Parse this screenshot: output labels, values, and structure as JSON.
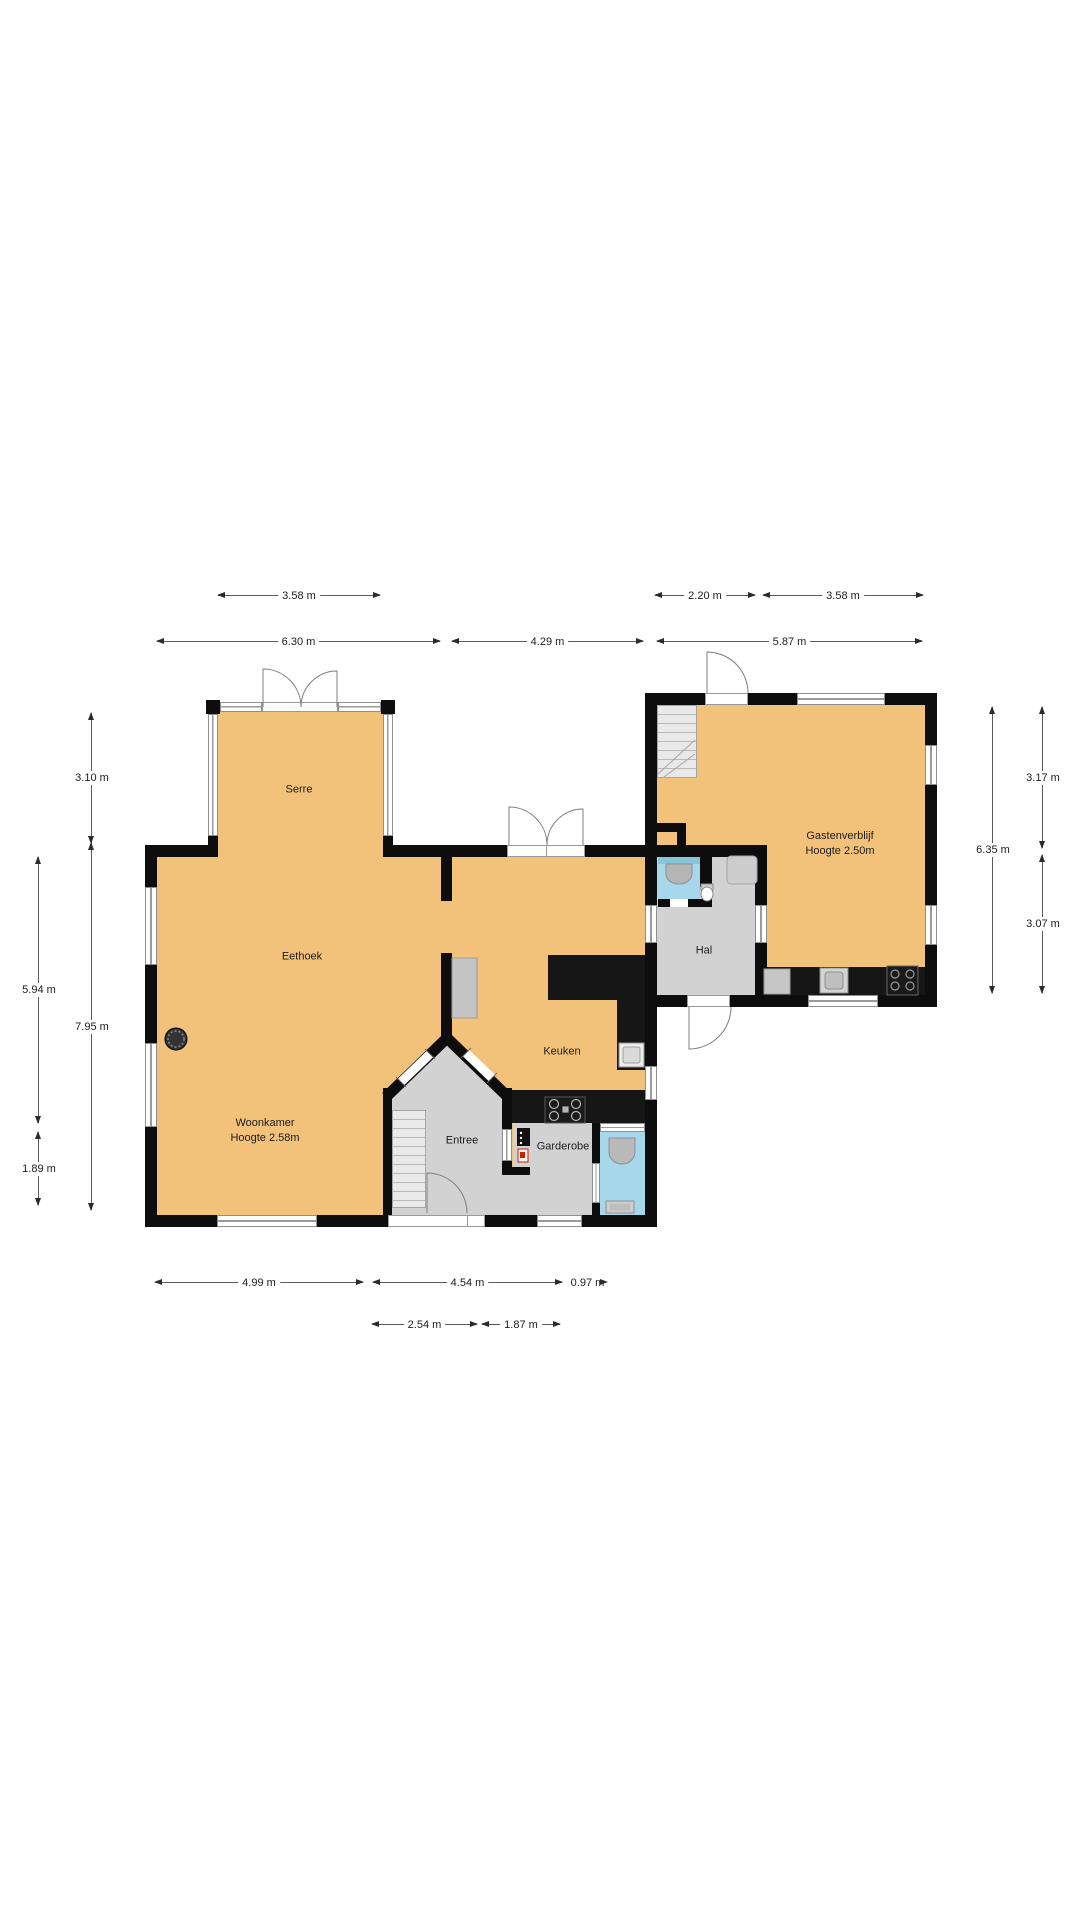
{
  "floorplan": {
    "rooms": {
      "serre": {
        "label": "Serre"
      },
      "eethoek": {
        "label": "Eethoek"
      },
      "woonkamer": {
        "label": "Woonkamer",
        "height": "Hoogte 2.58m"
      },
      "keuken": {
        "label": "Keuken"
      },
      "entree": {
        "label": "Entree"
      },
      "garderobe": {
        "label": "Garderobe"
      },
      "hal": {
        "label": "Hal"
      },
      "gastenverblijf": {
        "label": "Gastenverblijf",
        "height": "Hoogte 2.50m"
      }
    },
    "dimensions": {
      "top_upper": {
        "serre": "3.58 m",
        "entry": "2.20 m",
        "guest": "3.58 m"
      },
      "top_main": {
        "main": "6.30 m",
        "gap": "4.29 m",
        "guest": "5.87 m"
      },
      "left_inner": {
        "serre": "3.10 m",
        "main": "7.95 m"
      },
      "left_outer": {
        "upper": "5.94 m",
        "lower": "1.89 m"
      },
      "right_inner": {
        "guest": "6.35 m"
      },
      "right_outer": {
        "upper": "3.17 m",
        "lower": "3.07 m"
      },
      "bottom_main": {
        "left": "4.99 m",
        "mid": "4.54 m",
        "right": "0.97 m"
      },
      "bottom_inner": {
        "left": "2.54 m",
        "right": "1.87 m"
      }
    },
    "colors": {
      "floor": "#f2c17a",
      "circulation": "#d2d2d2",
      "sanitary": "#a6d7ea",
      "wall": "#0d0d0d"
    }
  }
}
